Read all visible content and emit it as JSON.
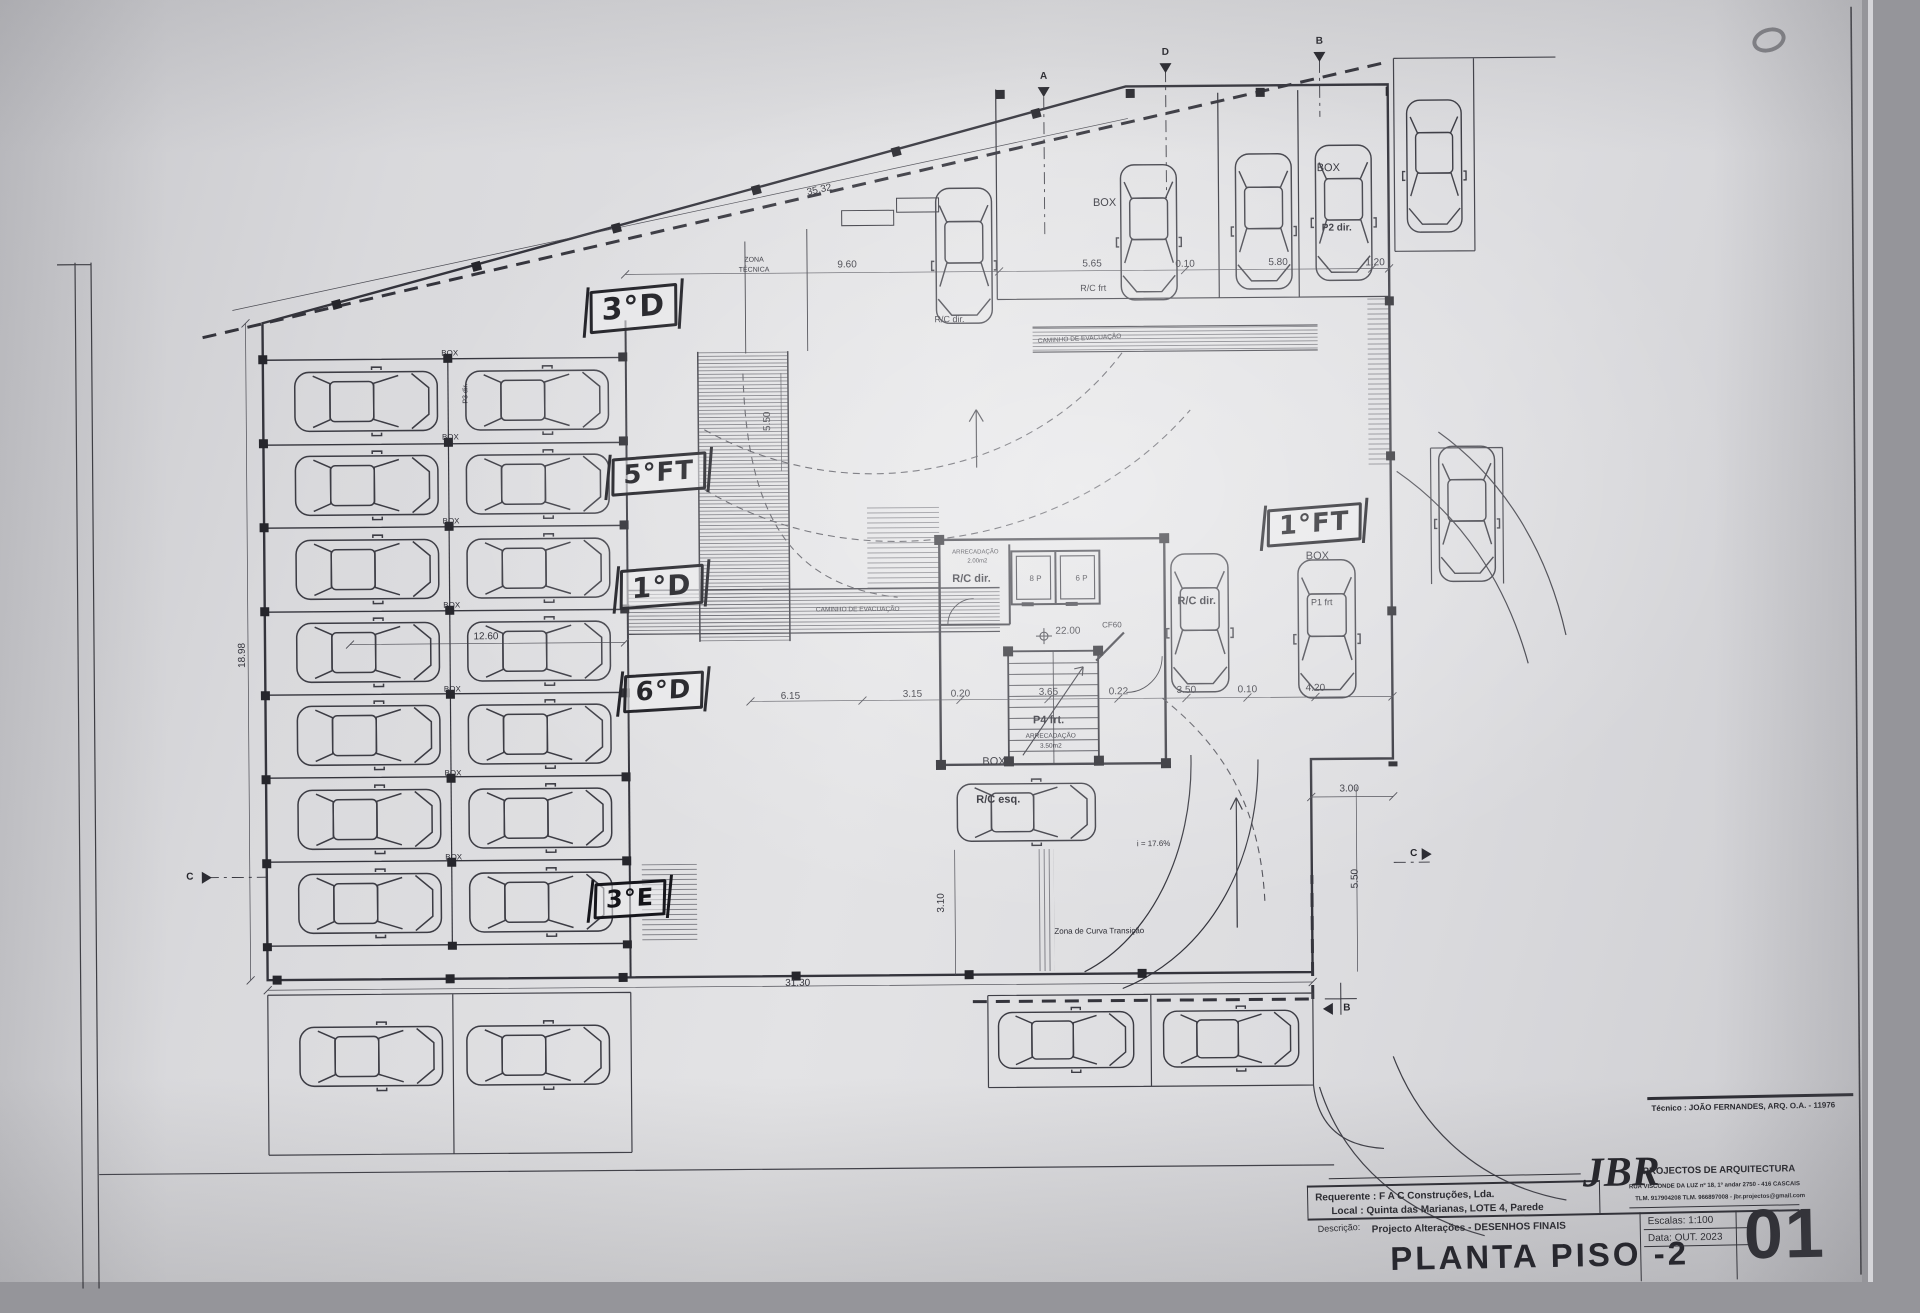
{
  "page": {
    "sheet_title": "PLANTA PISO -2",
    "sheet_number": "01",
    "tecnico": "Técnico : JOÃO FERNANDES, ARQ.   O.A. - 11976",
    "requerente": "Requerente : F A C  Construções, Lda.",
    "local": "Local : Quinta das Marianas, LOTE 4, Parede",
    "descricao_label": "Descrição:",
    "descricao": "Projecto Alterações - DESENHOS FINAIS",
    "firm_name": "JBR",
    "firm_tagline": "PROJECTOS DE ARQUITECTURA",
    "firm_address": "RUA VISCONDE DA LUZ nº 18, 1º andar  2750 - 416  CASCAIS",
    "firm_contacts": "TLM. 917904208  TLM. 966897008 - jbr.projectos@gmail.com",
    "escalas": "Escalas: 1:100",
    "data_line": "Data: OUT. 2023"
  },
  "plan": {
    "handwritten": [
      {
        "text": "3°D",
        "x": 636,
        "y": 306,
        "rot": -5,
        "size": 30
      },
      {
        "text": "5°FT",
        "x": 660,
        "y": 472,
        "rot": -4,
        "size": 26
      },
      {
        "text": "1°D",
        "x": 662,
        "y": 585,
        "rot": -4,
        "size": 28
      },
      {
        "text": "6°D",
        "x": 663,
        "y": 690,
        "rot": -3,
        "size": 26
      },
      {
        "text": "3°E",
        "x": 628,
        "y": 897,
        "rot": -3,
        "size": 24
      },
      {
        "text": "1°FT",
        "x": 1315,
        "y": 528,
        "rot": -4,
        "size": 26
      }
    ],
    "labels": [
      {
        "text": "BOX",
        "x": 452,
        "y": 350,
        "size": 8
      },
      {
        "text": "BOX",
        "x": 452,
        "y": 434,
        "size": 8
      },
      {
        "text": "BOX",
        "x": 452,
        "y": 518,
        "size": 8
      },
      {
        "text": "BOX",
        "x": 452,
        "y": 602,
        "size": 8
      },
      {
        "text": "BOX",
        "x": 452,
        "y": 686,
        "size": 8
      },
      {
        "text": "BOX",
        "x": 452,
        "y": 770,
        "size": 8
      },
      {
        "text": "BOX",
        "x": 452,
        "y": 854,
        "size": 8
      },
      {
        "text": "P3 dir.",
        "x": 468,
        "y": 390,
        "rot": -90,
        "size": 7
      },
      {
        "text": "BOX",
        "x": 1108,
        "y": 205,
        "size": 11
      },
      {
        "text": "R/C frt",
        "x": 1096,
        "y": 290,
        "size": 9
      },
      {
        "text": "BOX",
        "x": 1332,
        "y": 172,
        "size": 11
      },
      {
        "text": "P2 dir.",
        "x": 1340,
        "y": 232,
        "size": 10,
        "bold": 1
      },
      {
        "text": "R/C dir.",
        "x": 952,
        "y": 320,
        "size": 9
      },
      {
        "text": "ARRECADAÇÃO",
        "x": 976,
        "y": 553,
        "size": 6
      },
      {
        "text": "2.00m2",
        "x": 978,
        "y": 562,
        "size": 6
      },
      {
        "text": "R/C dir.",
        "x": 972,
        "y": 580,
        "size": 11,
        "bold": 1
      },
      {
        "text": "8 P",
        "x": 1036,
        "y": 580,
        "size": 8
      },
      {
        "text": "6 P",
        "x": 1082,
        "y": 580,
        "size": 8
      },
      {
        "text": "CF60",
        "x": 1112,
        "y": 627,
        "size": 8
      },
      {
        "text": "P4 frt.",
        "x": 1048,
        "y": 722,
        "size": 11,
        "bold": 1
      },
      {
        "text": "ARRECADAÇÃO",
        "x": 1050,
        "y": 738,
        "size": 6.5
      },
      {
        "text": "3.50m2",
        "x": 1050,
        "y": 748,
        "size": 6.5
      },
      {
        "text": "BOX",
        "x": 1318,
        "y": 560,
        "size": 11
      },
      {
        "text": "P1 frt",
        "x": 1322,
        "y": 606,
        "size": 9
      },
      {
        "text": "R/C dir.",
        "x": 1197,
        "y": 604,
        "size": 11,
        "bold": 1
      },
      {
        "text": "BOX",
        "x": 993,
        "y": 763,
        "size": 11
      },
      {
        "text": "R/C esq.",
        "x": 997,
        "y": 801,
        "size": 11,
        "bold": 1
      },
      {
        "text": "i = 17.6%",
        "x": 1152,
        "y": 846,
        "size": 8
      },
      {
        "text": "Zona de Curva Transição",
        "x": 1097,
        "y": 933,
        "size": 8
      },
      {
        "text": "ZONA",
        "x": 757,
        "y": 259,
        "size": 7
      },
      {
        "text": "TÉCNICA",
        "x": 757,
        "y": 269,
        "size": 7
      },
      {
        "text": "CAMINHO DE EVACUAÇÃO",
        "x": 858,
        "y": 610,
        "size": 6.5
      },
      {
        "text": "CAMINHO DE EVACUAÇÃO",
        "x": 1082,
        "y": 341,
        "size": 6.5,
        "rot": -3
      }
    ],
    "dimensions": [
      {
        "text": "35.32",
        "x": 823,
        "y": 190,
        "rot": -12
      },
      {
        "text": "9.60",
        "x": 850,
        "y": 265
      },
      {
        "text": "5.65",
        "x": 1095,
        "y": 266
      },
      {
        "text": "0.10",
        "x": 1188,
        "y": 267
      },
      {
        "text": "5.80",
        "x": 1281,
        "y": 266
      },
      {
        "text": "1.20",
        "x": 1378,
        "y": 267
      },
      {
        "text": "6.15",
        "x": 790,
        "y": 696
      },
      {
        "text": "3.15",
        "x": 912,
        "y": 695
      },
      {
        "text": "0.20",
        "x": 960,
        "y": 695
      },
      {
        "text": "3.65",
        "x": 1048,
        "y": 694
      },
      {
        "text": "0.22",
        "x": 1118,
        "y": 694
      },
      {
        "text": "3.50",
        "x": 1186,
        "y": 693
      },
      {
        "text": "0.10",
        "x": 1247,
        "y": 693
      },
      {
        "text": "4.20",
        "x": 1315,
        "y": 692
      },
      {
        "text": "12.60",
        "x": 486,
        "y": 634
      },
      {
        "text": "31.30",
        "x": 795,
        "y": 983
      },
      {
        "text": "18.98",
        "x": 243,
        "y": 650,
        "rot": -90
      },
      {
        "text": "3.00",
        "x": 1348,
        "y": 793
      },
      {
        "text": "5.50",
        "x": 1354,
        "y": 882,
        "rot": -90
      },
      {
        "text": "3.10",
        "x": 940,
        "y": 903,
        "rot": -90
      },
      {
        "text": "5.50",
        "x": 770,
        "y": 420,
        "rot": -90
      },
      {
        "text": "22.00",
        "x": 1068,
        "y": 633
      }
    ],
    "markers": [
      {
        "text": "A",
        "x": 1048,
        "y": 78
      },
      {
        "text": "D",
        "x": 1170,
        "y": 55
      },
      {
        "text": "B",
        "x": 1324,
        "y": 45
      },
      {
        "text": "C",
        "x": 188,
        "y": 872
      },
      {
        "text": "C",
        "x": 1412,
        "y": 858
      },
      {
        "text": "B",
        "x": 1344,
        "y": 1012
      }
    ],
    "cars": [
      {
        "x": 368,
        "y": 397,
        "rot": 90
      },
      {
        "x": 539,
        "y": 397,
        "rot": 90
      },
      {
        "x": 368,
        "y": 481,
        "rot": 90
      },
      {
        "x": 539,
        "y": 481,
        "rot": 90
      },
      {
        "x": 368,
        "y": 565,
        "rot": 90
      },
      {
        "x": 539,
        "y": 565,
        "rot": 90
      },
      {
        "x": 368,
        "y": 648,
        "rot": 90
      },
      {
        "x": 539,
        "y": 648,
        "rot": 90
      },
      {
        "x": 368,
        "y": 731,
        "rot": 90
      },
      {
        "x": 539,
        "y": 731,
        "rot": 90
      },
      {
        "x": 368,
        "y": 815,
        "rot": 90
      },
      {
        "x": 539,
        "y": 815,
        "rot": 90
      },
      {
        "x": 368,
        "y": 899,
        "rot": 90
      },
      {
        "x": 539,
        "y": 899,
        "rot": 90
      },
      {
        "x": 967,
        "y": 256,
        "rot": 180,
        "s": 0.9
      },
      {
        "x": 1152,
        "y": 234,
        "rot": 180,
        "s": 0.9
      },
      {
        "x": 1267,
        "y": 224,
        "rot": 180,
        "s": 0.9
      },
      {
        "x": 1347,
        "y": 216,
        "rot": 180,
        "s": 0.9
      },
      {
        "x": 1438,
        "y": 170,
        "rot": 180,
        "s": 0.88
      },
      {
        "x": 1468,
        "y": 518,
        "rot": 180,
        "s": 0.9
      },
      {
        "x": 1200,
        "y": 625,
        "rot": 180,
        "s": 0.92
      },
      {
        "x": 1327,
        "y": 632,
        "rot": 180,
        "s": 0.92
      },
      {
        "x": 1025,
        "y": 813,
        "rot": 90,
        "s": 0.92
      },
      {
        "x": 368,
        "y": 1052,
        "rot": 90,
        "s": 0.95
      },
      {
        "x": 535,
        "y": 1052,
        "rot": 90,
        "s": 0.95
      },
      {
        "x": 1063,
        "y": 1041,
        "rot": 90,
        "s": 0.9
      },
      {
        "x": 1228,
        "y": 1041,
        "rot": 90,
        "s": 0.9
      }
    ]
  },
  "colors": {
    "paper": "#dedee1",
    "ink": "#34343c",
    "handwriting": "#16161c",
    "background": "#95959a"
  }
}
